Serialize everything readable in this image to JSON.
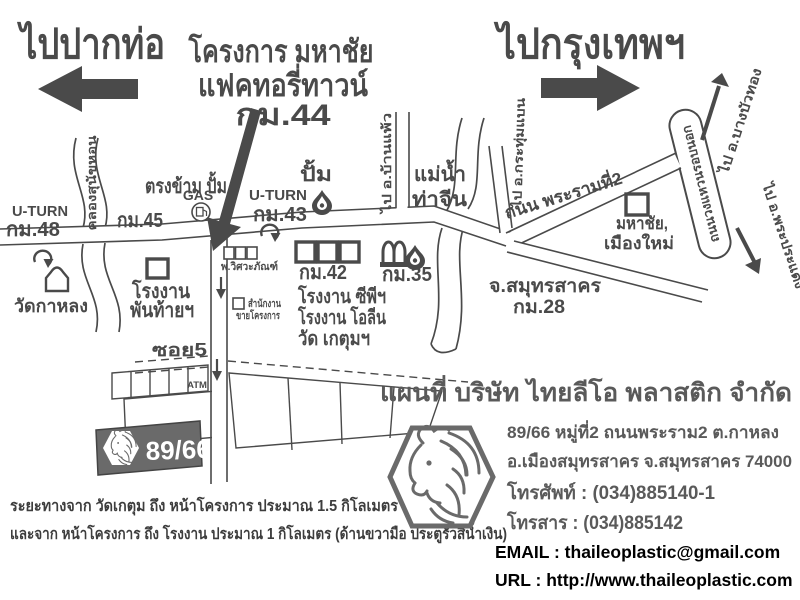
{
  "header": {
    "left_destination": "ไปปากท่อ",
    "project_line1": "โครงการ มหาชัย",
    "project_line2": "แฟคทอรี่ทาวน์",
    "project_line3": "กม.44",
    "right_destination": "ไปกรุงเทพฯ"
  },
  "map": {
    "uturn_label": "U-TURN",
    "km48": "กม.48",
    "km45": "กม.45",
    "km43": "กม.43",
    "km42": "กม.42",
    "km35": "กม.35",
    "canal": "คลองสุนัขหอน",
    "opposite_gas": "ตรงข้าม ปั้ม",
    "gas": "GAS",
    "pump": "ปั้ม",
    "wat_kalong": "วัดกาหลง",
    "factory_phanthai_line1": "โรงงาน",
    "factory_phanthai_line2": "พันท้ายฯ",
    "engineering_shop": "พ.วิศวะภัณฑ์",
    "sales_office_line1": "สำนักงาน",
    "sales_office_line2": "ขายโครงการ",
    "to_banphaeo": "ไป อ.บ้านแพ้ว",
    "river_line1": "แม่น้ำ",
    "river_line2": "ท่าจีน",
    "to_krathumbaen": "ไป อ.กระทุ่มแบน",
    "rama2_road": "ถนน พระรามที่2",
    "mahachai_line1": "มหาชัย,",
    "mahachai_line2": "เมืองใหม่",
    "samutsakhon": "จ.สมุทรสาคร",
    "km28": "กม.28",
    "factory_cp": "โรงงาน ซีพีฯ",
    "factory_olean": "โรงงาน โอลีน",
    "wat_ketum": "วัด เกตุมฯ",
    "ring_road": "ถนนวงแหวนรอบนอก",
    "to_bangbuathong": "ไป อ.บางบัวทอง",
    "to_phrapradaeng": "ไป อ.พระประแดง",
    "soi5": "ซอย5",
    "atm": "ATM",
    "plot_number": "89/66"
  },
  "notes": {
    "line1": "ระยะทางจาก วัดเกตุม ถึง หน้าโครงการ ประมาณ 1.5 กิโลเมตร",
    "line2": "และจาก หน้าโครงการ ถึง โรงงาน ประมาณ  1  กิโลเมตร (ด้านขวามือ ประตูรั้วสีน้ำเงิน)"
  },
  "company": {
    "title": "แผนที่  บริษัท ไทยลีโอ พลาสติก จำกัด",
    "address_line1": "89/66  หมู่ที่2  ถนนพระราม2  ต.กาหลง",
    "address_line2": "อ.เมืองสมุทรสาคร  จ.สมุทรสาคร 74000",
    "phone": "โทรศัพท์ : (034)885140-1",
    "fax": "โทรสาร  : (034)885142",
    "email": "EMAIL : thaileoplastic@gmail.com",
    "url": "URL : http://www.thaileoplastic.com"
  },
  "colors": {
    "ink": "#4a4a4a",
    "text_black": "#000000",
    "plot_fill": "#6a6a6a"
  }
}
